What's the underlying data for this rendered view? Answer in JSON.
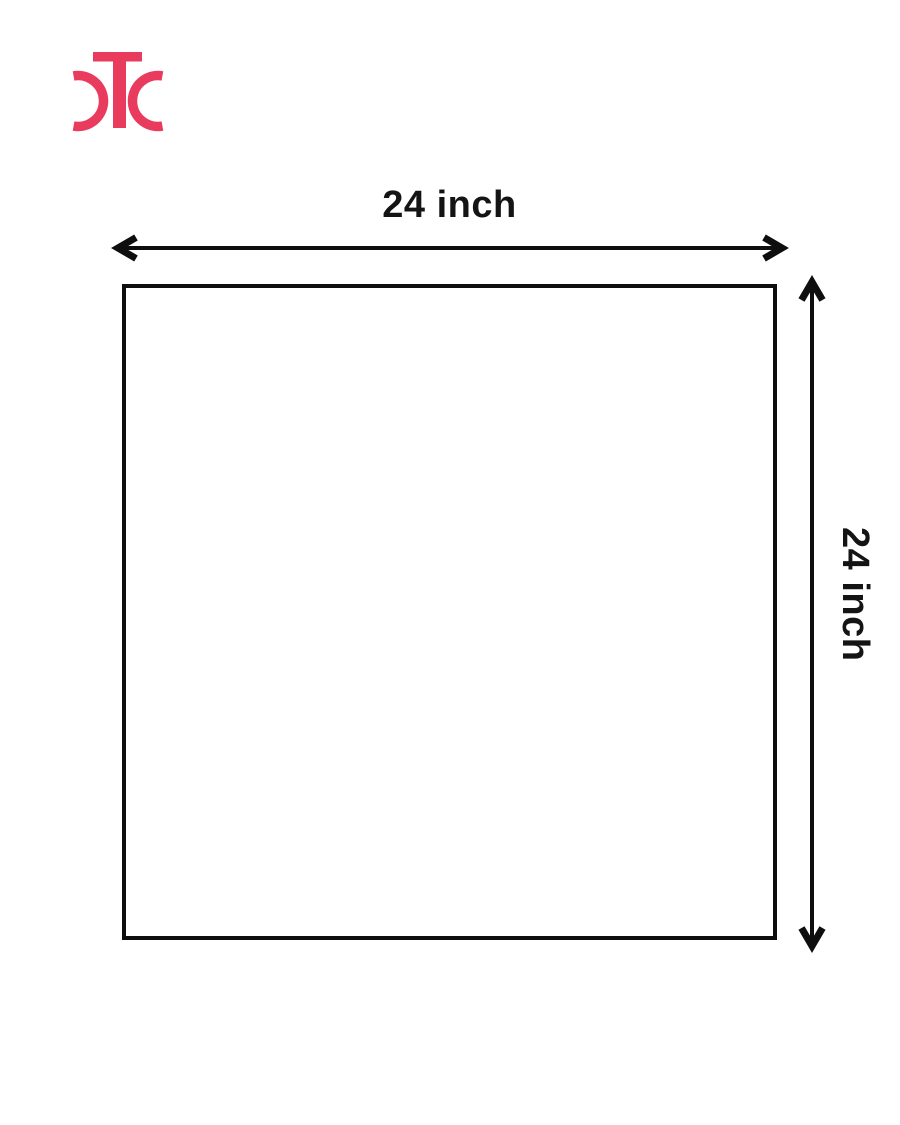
{
  "canvas": {
    "width": 900,
    "height": 1125,
    "background": "#ffffff"
  },
  "logo": {
    "monogram": "CTC",
    "color": "#e93b5d"
  },
  "dimensions": {
    "top": {
      "label": "24 inch"
    },
    "right": {
      "label": "24 inch"
    }
  },
  "shape": {
    "type": "square",
    "border_color": "#0e0e0e"
  },
  "arrows": {
    "style": "double-headed",
    "color": "#0e0e0e"
  }
}
